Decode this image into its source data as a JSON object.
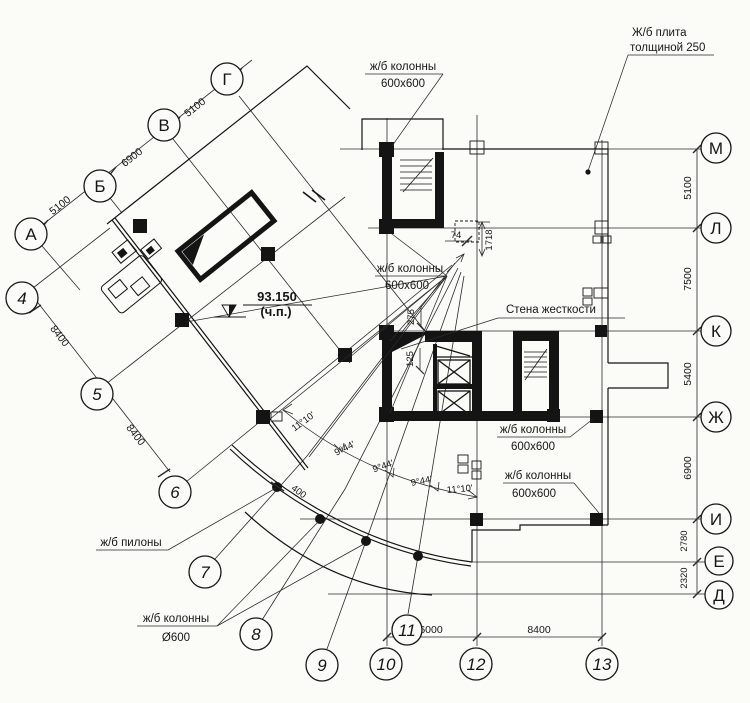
{
  "drawing": {
    "type": "structural-floor-plan",
    "colors": {
      "paper": "#fbfbf8",
      "ink": "#161616"
    }
  },
  "grid": {
    "rotated_letters": [
      {
        "label": "Г"
      },
      {
        "label": "В"
      },
      {
        "label": "Б"
      },
      {
        "label": "А"
      }
    ],
    "right_letters": [
      {
        "label": "М"
      },
      {
        "label": "Л"
      },
      {
        "label": "К"
      },
      {
        "label": "Ж"
      },
      {
        "label": "И"
      },
      {
        "label": "Е"
      },
      {
        "label": "Д"
      }
    ],
    "numbers": [
      {
        "label": "4"
      },
      {
        "label": "5"
      },
      {
        "label": "6"
      },
      {
        "label": "7"
      },
      {
        "label": "8"
      },
      {
        "label": "9"
      },
      {
        "label": "10"
      },
      {
        "label": "11"
      },
      {
        "label": "12"
      },
      {
        "label": "13"
      }
    ]
  },
  "dims": {
    "letter_chain": [
      "5100",
      "6900",
      "5100"
    ],
    "number_chain": [
      "8400",
      "8400"
    ],
    "right_chain": [
      "5100",
      "7500",
      "5400",
      "6900",
      "2780",
      "2320"
    ],
    "bottom_chain": [
      "6000",
      "8400"
    ],
    "angles": [
      "11°10'",
      "9°44'",
      "9°44'",
      "9°44'",
      "11°10'"
    ],
    "small": {
      "d74": "74",
      "d1718": "1718",
      "d275": "275",
      "d125": "125",
      "d400": "400"
    }
  },
  "callouts": {
    "top_columns": {
      "line1": "ж/б колонны",
      "line2": "600х600"
    },
    "slab": {
      "line1": "Ж/б плита",
      "line2": "толщиной 250"
    },
    "mid_columns": {
      "line1": "ж/б колонны",
      "line2": "600х600"
    },
    "shear_wall": {
      "line1": "Стена жесткости"
    },
    "right_columns_upper": {
      "line1": "ж/б колонны",
      "line2": "600х600"
    },
    "right_columns_lower": {
      "line1": "ж/б колонны",
      "line2": "600х600"
    },
    "pylons": {
      "line1": "ж/б пилоны"
    },
    "round_columns": {
      "line1": "ж/б колонны",
      "line2": "Ø600"
    },
    "elevation": {
      "value": "93.150",
      "note": "(ч.п.)"
    }
  }
}
